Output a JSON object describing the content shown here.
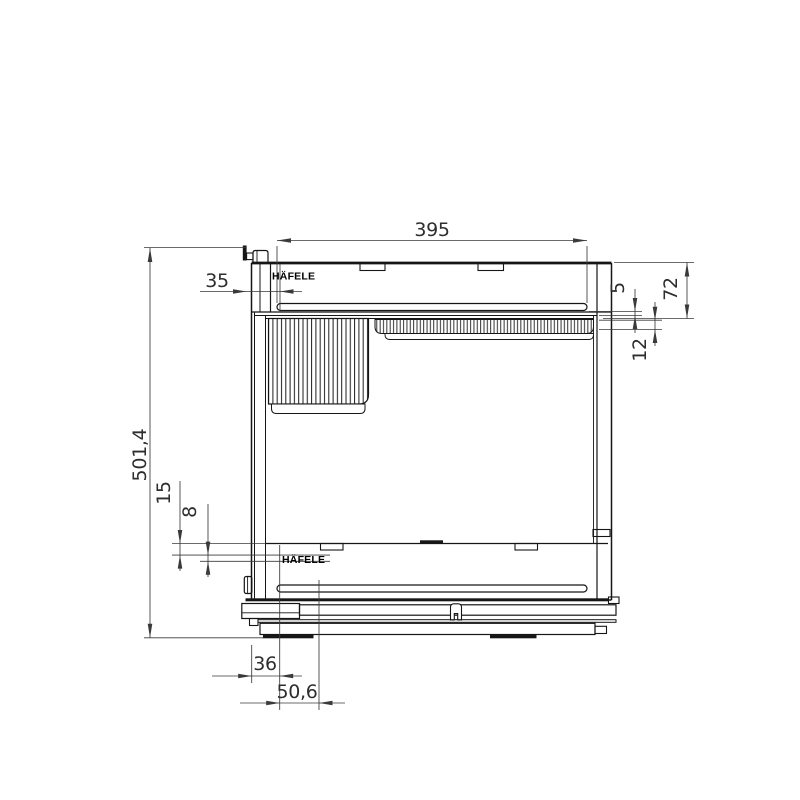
{
  "brand": "HÄFELE",
  "dims": {
    "top_slot_length": "395",
    "front_inset": "35",
    "panel_gap": "5",
    "front_panel_height": "72",
    "grille_height": "12",
    "overall_height": "501,4",
    "bottom_offset_a": "15",
    "bottom_offset_b": "8",
    "base_offset": "36",
    "base_depth": "50,6"
  }
}
